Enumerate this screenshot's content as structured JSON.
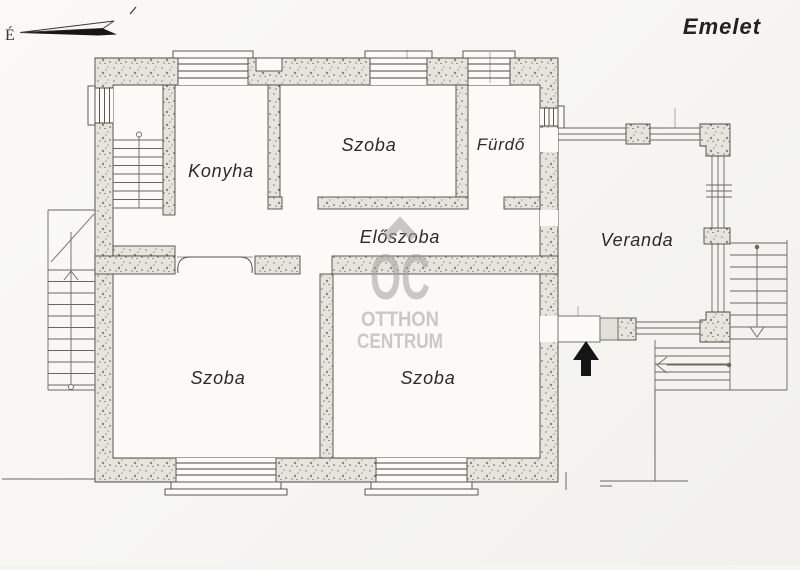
{
  "title": "Emelet",
  "compass": {
    "label": "É"
  },
  "rooms": [
    {
      "id": "konyha",
      "label": "Konyha"
    },
    {
      "id": "szoba-top",
      "label": "Szoba"
    },
    {
      "id": "furdo",
      "label": "Fürdő"
    },
    {
      "id": "eloszoba",
      "label": "Előszoba"
    },
    {
      "id": "szoba-bottom-left",
      "label": "Szoba"
    },
    {
      "id": "szoba-bottom-right",
      "label": "Szoba"
    },
    {
      "id": "veranda",
      "label": "Veranda"
    }
  ],
  "watermark": {
    "logo": "OC",
    "line1": "OTTHON",
    "line2": "CENTRUM"
  },
  "colors": {
    "paper": "#f7f6f3",
    "wall_fill": "#e7e4de",
    "line": "#4b4843",
    "watermark_gray": "#a2a09d",
    "arrow_black": "#151515"
  }
}
